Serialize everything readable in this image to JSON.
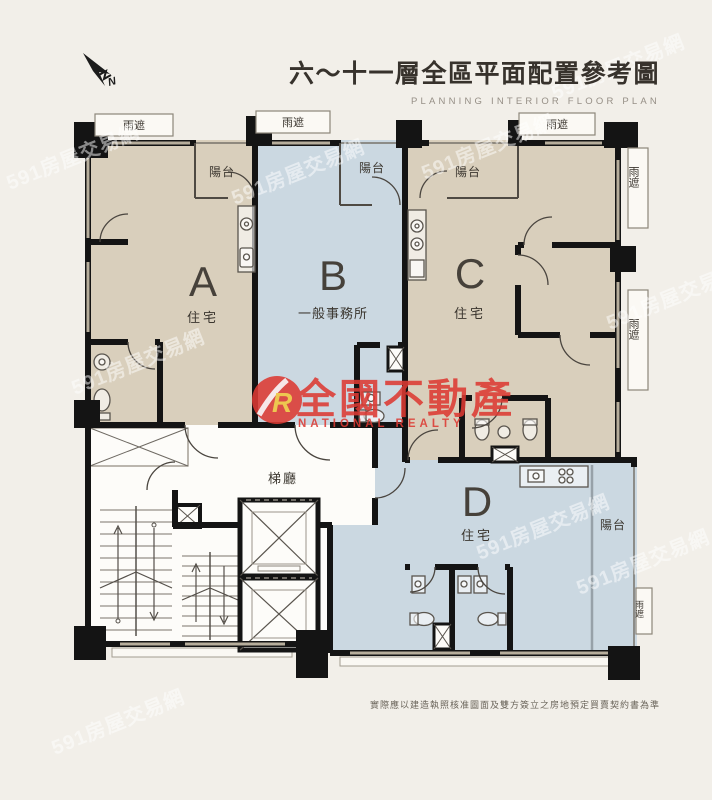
{
  "header": {
    "title": "六～十一層全區平面配置參考圖",
    "subtitle": "PLANNING  INTERIOR  FLOOR  PLAN"
  },
  "compass": {
    "label": "N"
  },
  "plan": {
    "units": [
      {
        "letter": "A",
        "type": "住宅"
      },
      {
        "letter": "B",
        "type": "一般事務所"
      },
      {
        "letter": "C",
        "type": "住宅"
      },
      {
        "letter": "D",
        "type": "住宅"
      }
    ],
    "labels": {
      "rain_shade": "雨遮",
      "balcony": "陽台",
      "stair_hall": "梯廳"
    }
  },
  "palette": {
    "beige": "#d9cfbc",
    "blue": "#cbd8e1",
    "background": "#f2efe9",
    "wall": "#141414",
    "logo_red": "#dd3a33"
  },
  "logo": {
    "symbol": "R",
    "name_zh": "全國不動產",
    "name_en": "NATIONAL REALTY"
  },
  "watermark": {
    "text": "591房屋交易網"
  },
  "footer": {
    "disclaimer": "實際應以建造執照核准圖面及雙方簽立之房地預定買賣契約書為準"
  }
}
